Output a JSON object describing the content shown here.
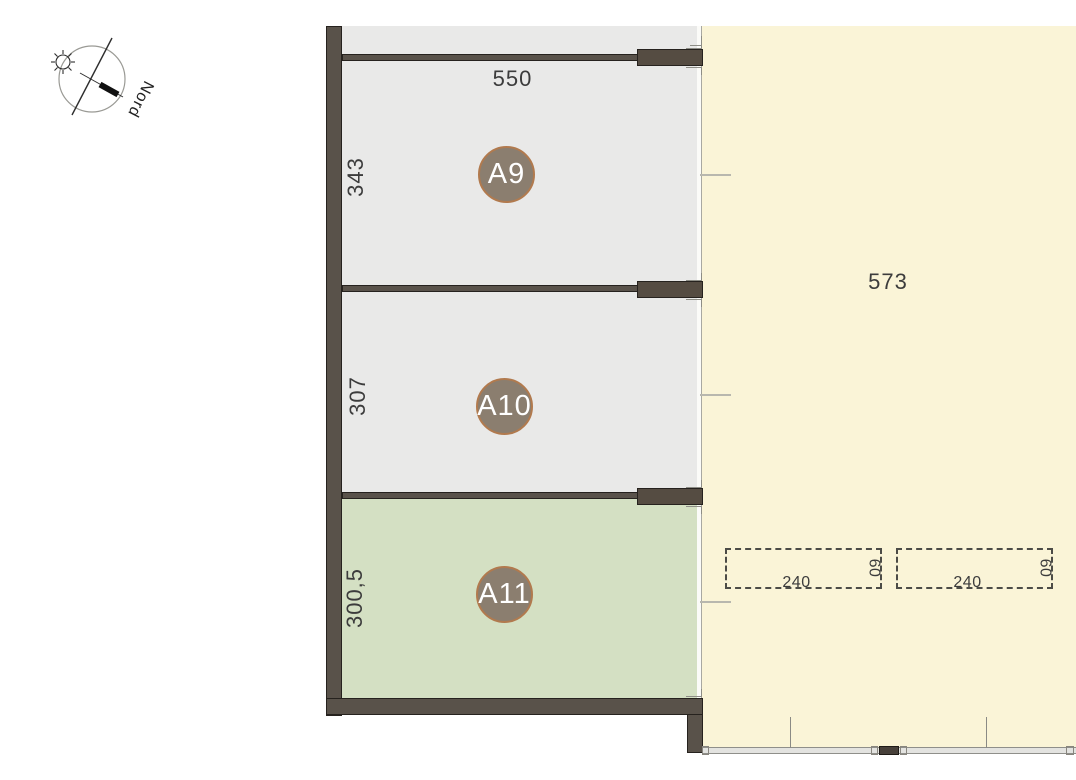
{
  "compass": {
    "label": "Nord"
  },
  "plan": {
    "rooms": [
      {
        "label": "A9",
        "width_dim": "550",
        "height_dim": "343"
      },
      {
        "label": "A10",
        "height_dim": "307"
      },
      {
        "label": "A11",
        "height_dim": "300,5"
      }
    ],
    "outdoor_area": {
      "dim": "573"
    },
    "parking_spaces": [
      {
        "length_dim": "240",
        "depth_dim": "60"
      },
      {
        "length_dim": "240",
        "depth_dim": "60"
      }
    ]
  },
  "colors": {
    "wall": "#59524a",
    "wall_block": "#554c42",
    "room_fill": "#e9e9e8",
    "highlight_room_fill": "#d4e0c3",
    "outdoor_fill": "#faf4d7",
    "label_circle_fill": "#8b7e6f",
    "label_circle_border": "#b17a4e",
    "dim_text": "#3c3c3c"
  }
}
